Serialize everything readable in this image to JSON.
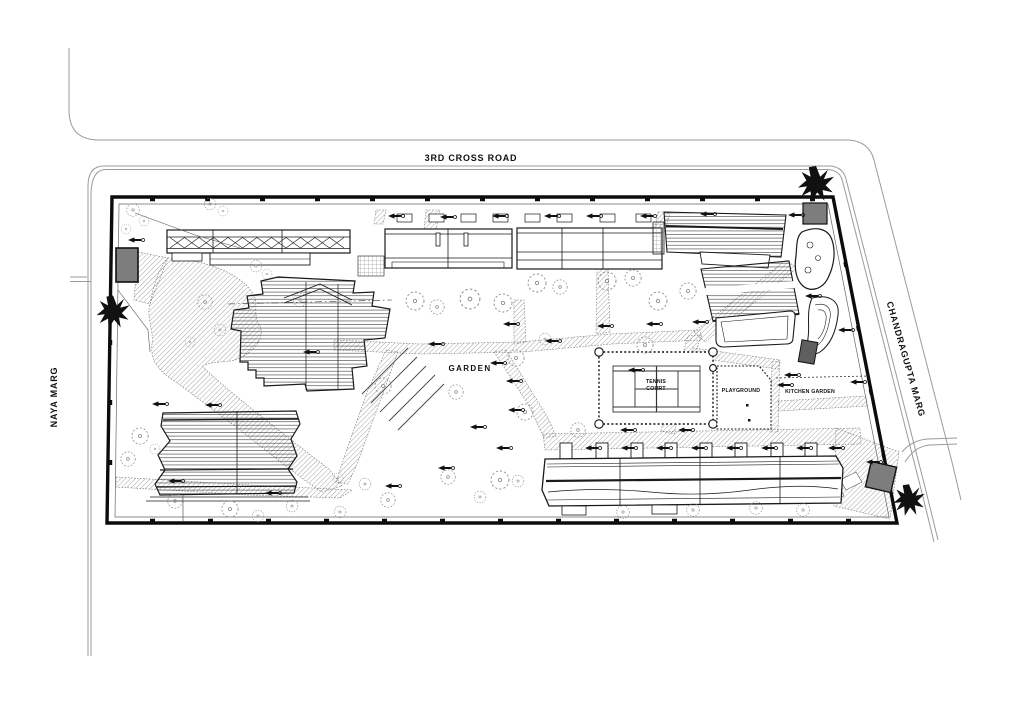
{
  "drawing": {
    "roads": {
      "top_label": "3RD CROSS ROAD",
      "left_label": "NAYA MARG",
      "right_label": "CHANDRAGUPTA MARG"
    },
    "site_labels": {
      "garden": "GARDEN",
      "tennis_line1": "TENNIS",
      "tennis_line2": "COURT",
      "playground": "PLAYGROUND",
      "kitchen_garden": "KITCHEN GARDEN"
    }
  },
  "icons": {
    "black-tree-icon": "jagged-star-tree-shape",
    "shrub-tree-icon": "dashed-circle-with-center-dot",
    "direction-arrow-icon": "left-pointing-arrow-with-tail-circle"
  },
  "colors": {
    "ink": "#1a1a1a",
    "gate_fill": "#7d7d7d",
    "dark_gate_fill": "#5f5f5f",
    "hatch_line": "#8f8f8f",
    "road_line": "#9b9b9b",
    "tree_line": "#8a8a8a",
    "background": "#ffffff"
  }
}
